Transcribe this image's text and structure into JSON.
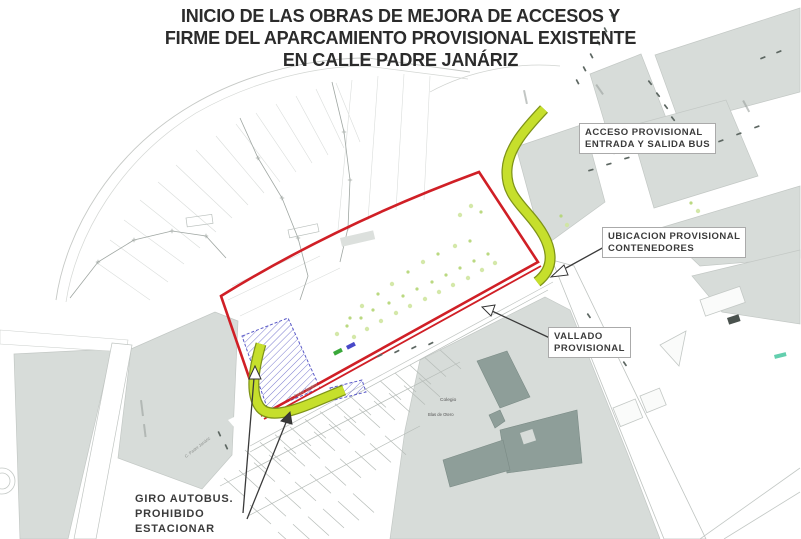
{
  "title": {
    "line1": "INICIO DE LAS OBRAS DE MEJORA DE ACCESOS Y",
    "line2": "FIRME DEL APARCAMIENTO PROVISIONAL EXISTENTE",
    "line3": "EN CALLE PADRE JANÁRIZ"
  },
  "annotations": {
    "acceso": {
      "line1": "ACCESO PROVISIONAL",
      "line2": "ENTRADA Y SALIDA BUS"
    },
    "ubicacion": {
      "line1": "UBICACION PROVISIONAL",
      "line2": "CONTENEDORES"
    },
    "vallado": {
      "line1": "VALLADO",
      "line2": "PROVISIONAL"
    },
    "giro": {
      "line1": "GIRO AUTOBUS.",
      "line2": "PROHIBIDO",
      "line3": "ESTACIONAR"
    }
  },
  "map_texts": {
    "colegio": "Colegio",
    "colegio_sub": "Blas de Otero",
    "street_padre_janariz": "C. Padre Janáriz"
  },
  "colors": {
    "work_area_red": "#d01f26",
    "bus_route_green": "#c6df2c",
    "hatch_blue": "#5b5bc8",
    "school_gray": "#8e9e99",
    "block_gray": "#d7dcd9"
  }
}
